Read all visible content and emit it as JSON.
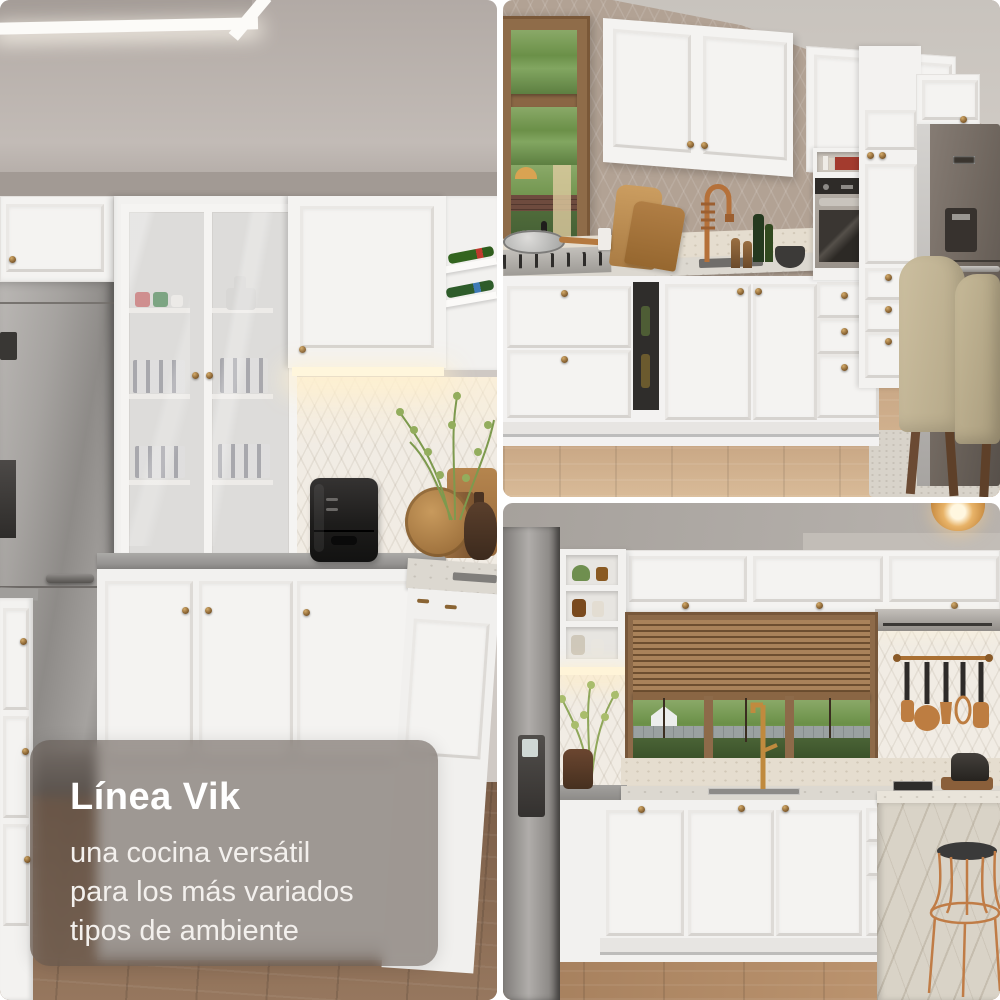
{
  "caption": {
    "title": "Línea Vik",
    "subtitle": "una cocina versátil\npara los más variados\ntipos de ambiente"
  },
  "palette": {
    "caption_bg": "rgba(90,79,71,0.55)",
    "caption_text": "#ffffff",
    "gap_color": "#ffffff",
    "cabinet_white": "#f3f2f0",
    "brass_knob": "#8a6433",
    "taupe_wall": "#b2a294",
    "copper_accent": "#b5713a",
    "wood_floor_left": "#86674f",
    "wood_floor_right": "#b08a67"
  }
}
